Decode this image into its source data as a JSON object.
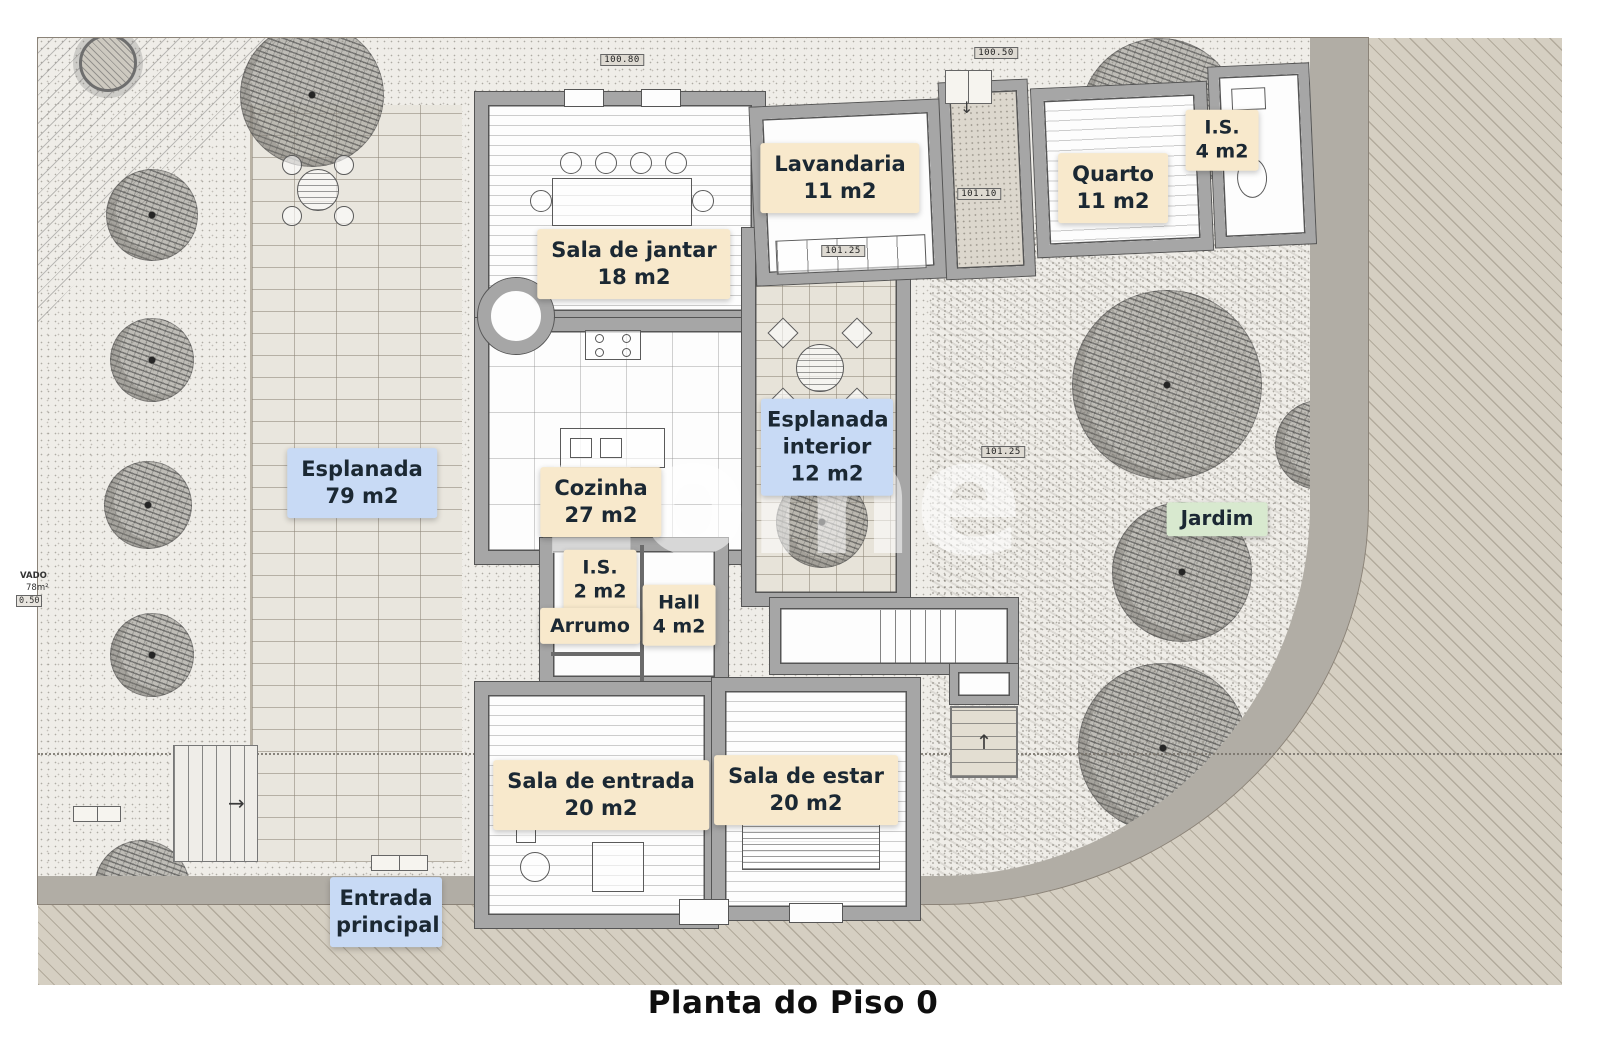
{
  "title": "Planta do Piso 0",
  "watermark": "zome",
  "rooms": {
    "esplanada": {
      "name": "Esplanada",
      "area": "79 m2"
    },
    "sala_jantar": {
      "name": "Sala de jantar",
      "area": "18 m2"
    },
    "lavandaria": {
      "name": "Lavandaria",
      "area": "11 m2"
    },
    "quarto": {
      "name": "Quarto",
      "area": "11 m2"
    },
    "is_4": {
      "name": "I.S.",
      "area": "4 m2"
    },
    "esplanada_interior": {
      "name": "Esplanada interior",
      "area": "12 m2"
    },
    "cozinha": {
      "name": "Cozinha",
      "area": "27 m2"
    },
    "is_2": {
      "name": "I.S.",
      "area": "2 m2"
    },
    "hall": {
      "name": "Hall",
      "area": "4 m2"
    },
    "arrumo": {
      "name": "Arrumo"
    },
    "jardim": {
      "name": "Jardim"
    },
    "sala_entrada": {
      "name": "Sala de entrada",
      "area": "20 m2"
    },
    "sala_estar": {
      "name": "Sala de estar",
      "area": "20 m2"
    },
    "entrada_principal": {
      "name": "Entrada principal"
    }
  },
  "markers": {
    "top_left": "100.80",
    "top_right": "100.50",
    "corridor": "101.10",
    "passage": "101.25",
    "patio": "101.25",
    "edge_level": "0.50"
  },
  "edge_texts": {
    "cut1": "VADO",
    "cut2": "78m²"
  },
  "icons": {
    "arrow_up": "↑",
    "arrow_down": "↓",
    "arrow_right": "→"
  },
  "colors": {
    "label_cream": "#f8e9cc",
    "label_blue": "#c8daf5",
    "label_green": "#d8e9cf",
    "ink": "#1b2833",
    "wall": "#a6a6a6",
    "road": "#b1ada5",
    "street": "#d5cfc2"
  }
}
